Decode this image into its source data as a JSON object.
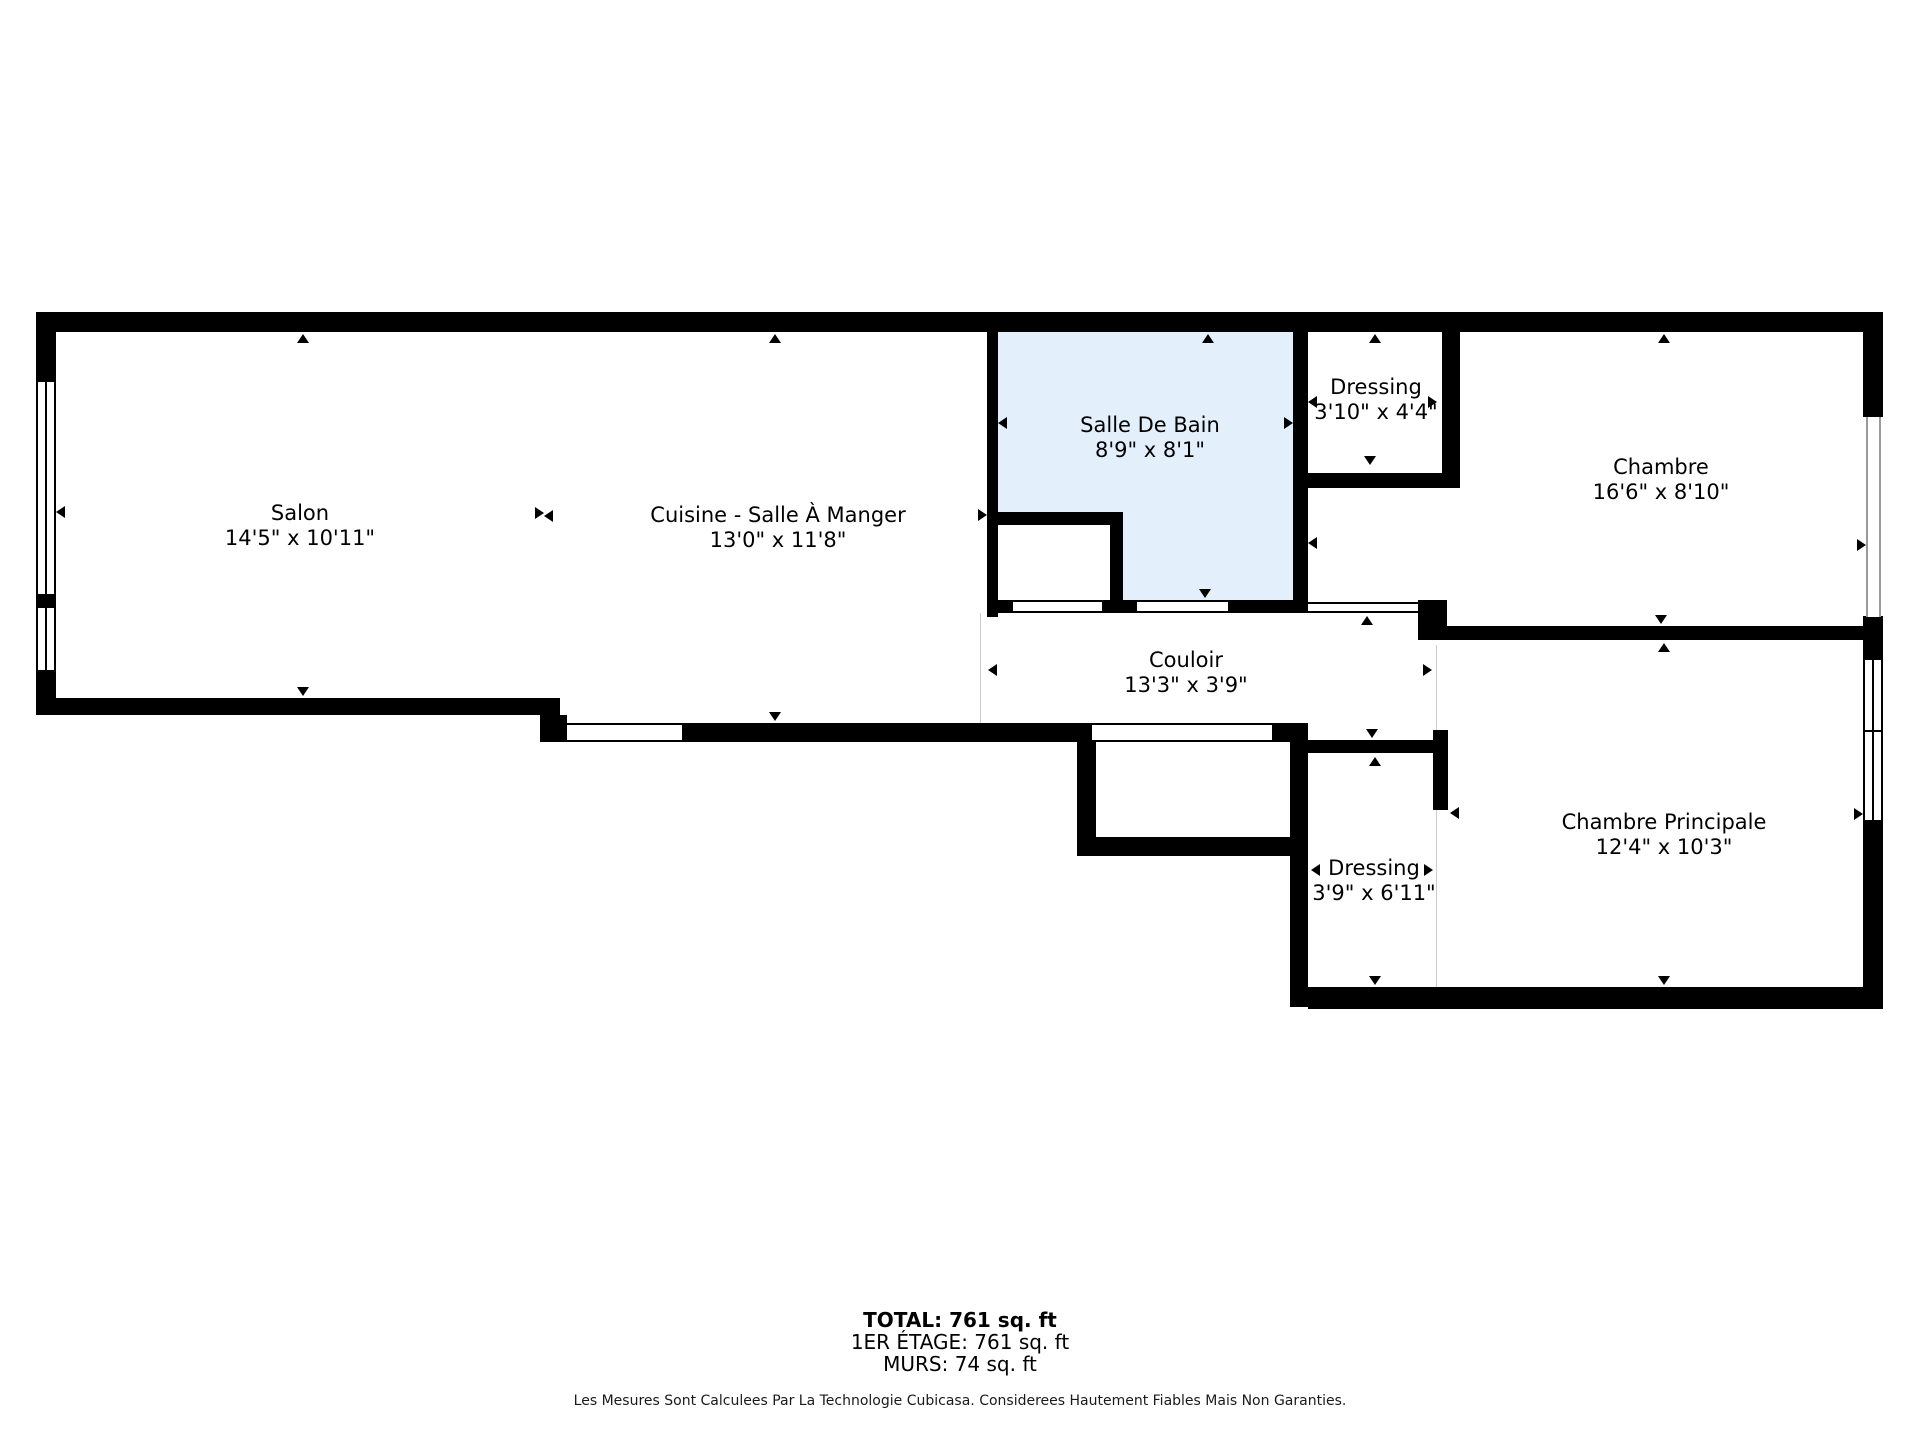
{
  "rooms": {
    "salon": {
      "name": "Salon",
      "dims": "14'5\" x 10'11\""
    },
    "cuisine": {
      "name": "Cuisine - Salle À Manger",
      "dims": "13'0\" x 11'8\""
    },
    "salle_de_bain": {
      "name": "Salle De Bain",
      "dims": "8'9\" x 8'1\""
    },
    "dressing_haut": {
      "name": "Dressing",
      "dims": "3'10\" x 4'4\""
    },
    "chambre": {
      "name": "Chambre",
      "dims": "16'6\" x 8'10\""
    },
    "couloir": {
      "name": "Couloir",
      "dims": "13'3\" x 3'9\""
    },
    "dressing_bas": {
      "name": "Dressing",
      "dims": "3'9\" x 6'11\""
    },
    "chambre_principale": {
      "name": "Chambre Principale",
      "dims": "12'4\" x 10'3\""
    }
  },
  "summary": {
    "total": "TOTAL: 761 sq. ft",
    "floor": "1ER ÉTAGE: 761 sq. ft",
    "walls": "MURS: 74 sq. ft"
  },
  "disclaimer": "Les Mesures Sont Calculees Par La Technologie Cubicasa. Considerees Hautement Fiables Mais Non Garanties.",
  "colors": {
    "wall": "#000000",
    "bathroom_fill": "#e3effb",
    "glass_line": "#9a9a9a"
  }
}
